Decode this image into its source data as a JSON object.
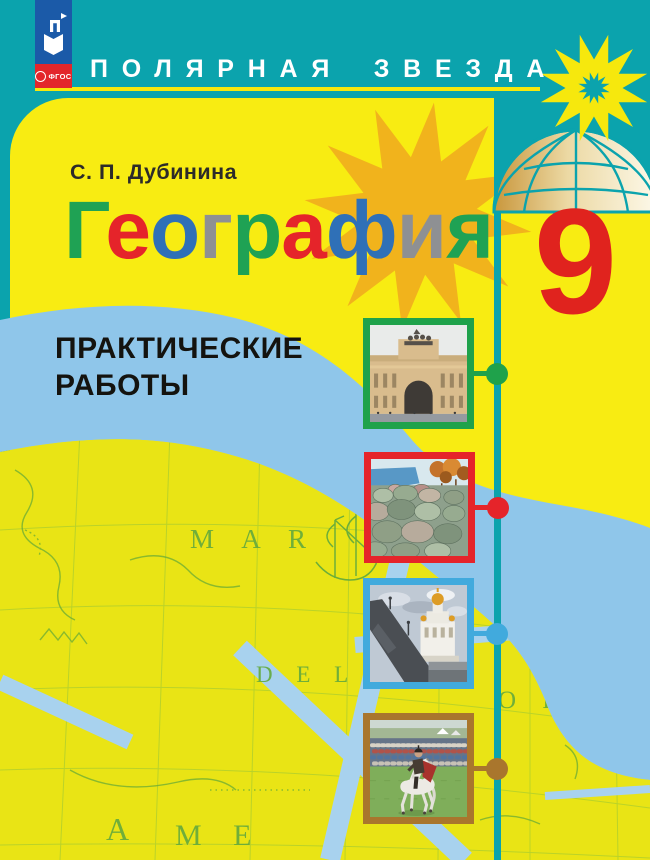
{
  "series_banner": {
    "title": "ПОЛЯРНАЯ ЗВЕЗДА"
  },
  "publisher": {
    "logo_letter": "П",
    "fgos": "ФГОС"
  },
  "book": {
    "author": "С. П. Дубинина",
    "title": "География",
    "title_letters": [
      {
        "ch": "Г",
        "color": "#1fa254"
      },
      {
        "ch": "е",
        "color": "#e5242a"
      },
      {
        "ch": "о",
        "color": "#2f70b7"
      },
      {
        "ch": "г",
        "color": "#8e9093"
      },
      {
        "ch": "р",
        "color": "#1fa254"
      },
      {
        "ch": "а",
        "color": "#e5242a"
      },
      {
        "ch": "ф",
        "color": "#2f70b7"
      },
      {
        "ch": "и",
        "color": "#8e9093"
      },
      {
        "ch": "я",
        "color": "#1fa254"
      }
    ],
    "grade": "9",
    "subtitle_line1": "ПРАКТИЧЕСКИЕ",
    "subtitle_line2": "РАБОТЫ"
  },
  "map_labels": {
    "label1": "M A R",
    "label2": "D E L",
    "label3": "O R T",
    "label4": "M E",
    "label5": "A"
  },
  "photos": [
    {
      "name": "arch-building-photo",
      "frame_color": "#1fa24b"
    },
    {
      "name": "rocky-seashore-photo",
      "frame_color": "#e5242a"
    },
    {
      "name": "cathedral-bridge-photo",
      "frame_color": "#41aadd"
    },
    {
      "name": "horse-rider-photo",
      "frame_color": "#a9762d"
    }
  ],
  "colors": {
    "background_teal": "#0ba3ad",
    "card_yellow": "#f8ec12",
    "map_yellow": "#e9e415",
    "ring_blue": "#8fc6ea",
    "grade_red": "#e0231e",
    "star_gold": "#f1b31c",
    "star_yellow": "#f6e80d",
    "publisher_blue": "#1b5aa8",
    "fgos_red": "#e3262b",
    "banner_text": "#ffffff"
  }
}
